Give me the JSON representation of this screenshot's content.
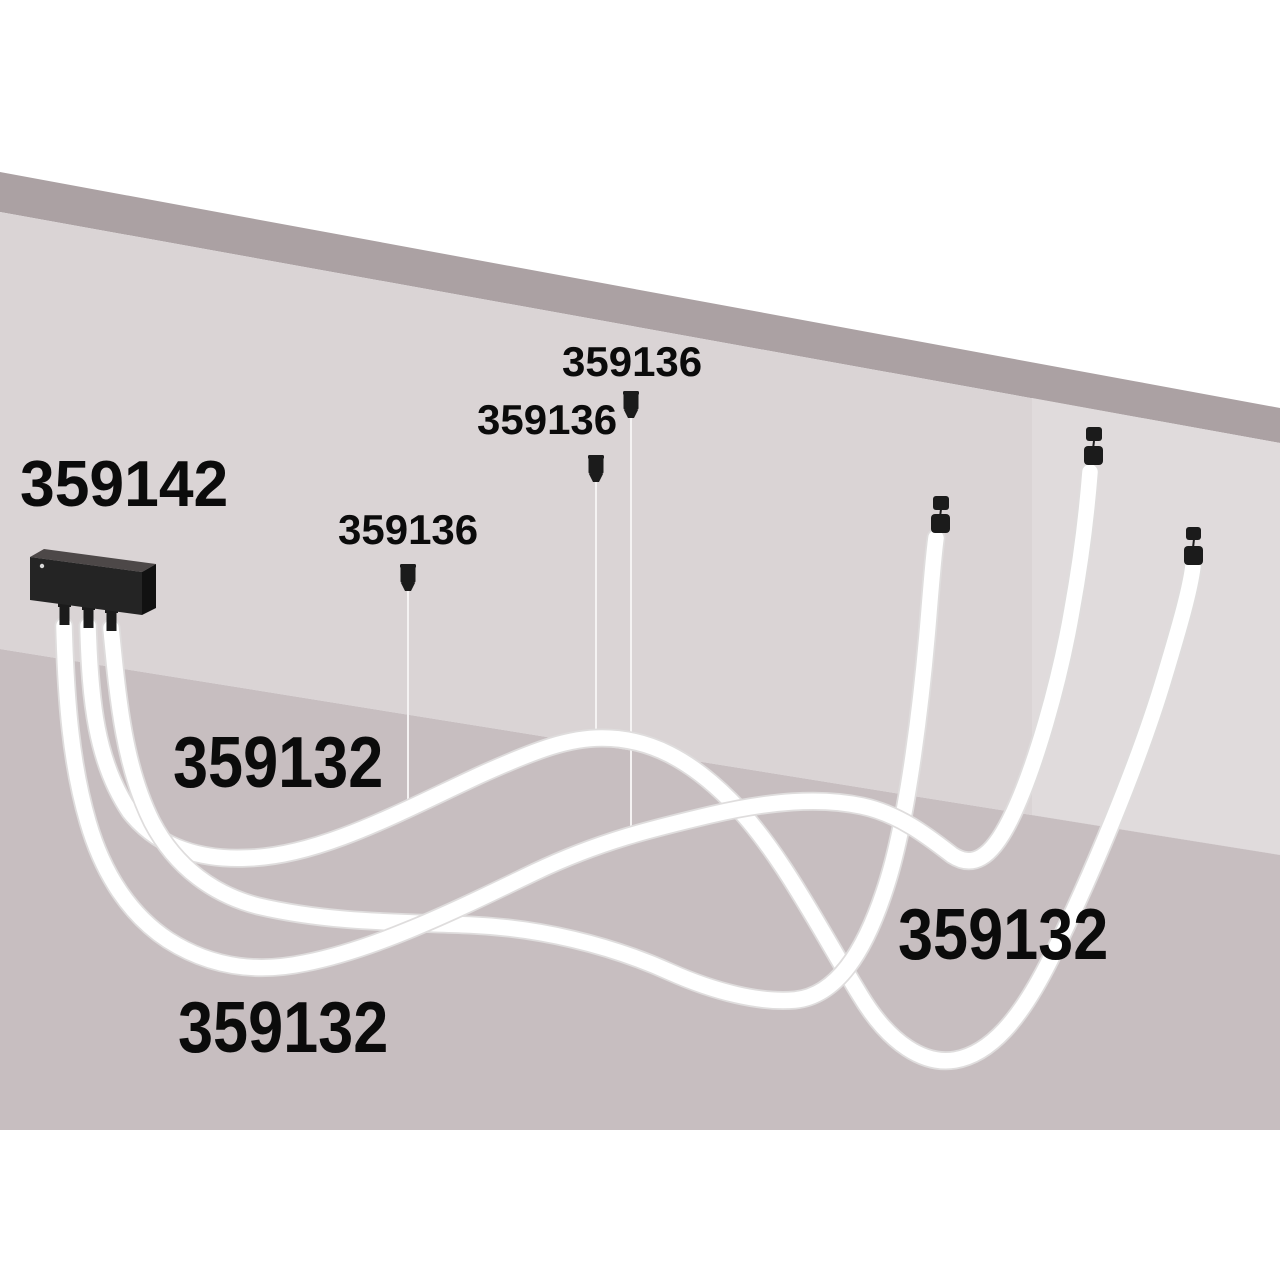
{
  "labels": {
    "driver": "359142",
    "suspension_1": "359136",
    "suspension_2": "359136",
    "suspension_3": "359136",
    "tube_left": "359132",
    "tube_bottom": "359132",
    "tube_right": "359132"
  },
  "colors": {
    "background": "#ffffff",
    "ceiling_edge_band": "#aba1a3",
    "ceiling_surface": "#dad4d5",
    "ceiling_surface_light": "#e0dbdc",
    "lower_wall": "#c7bec0",
    "tube": "#ffffff",
    "tube_edge": "#dfdddd",
    "hardware_black": "#1b1b1b",
    "label_text": "#0b0b0b"
  }
}
